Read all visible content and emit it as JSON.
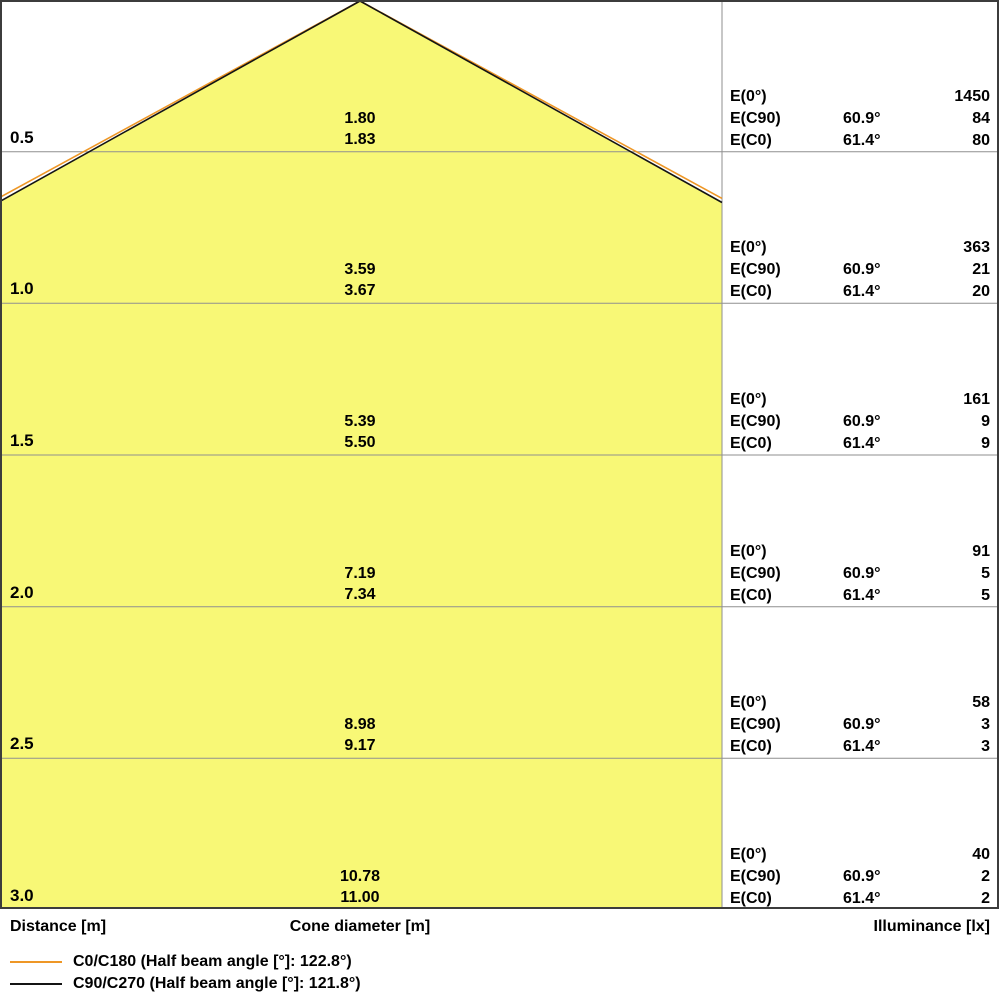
{
  "chart_data": {
    "type": "area",
    "subtype": "photometric-light-cone-diagram",
    "distance_axis_label": "Distance [m]",
    "cone_axis_label": "Cone diameter [m]",
    "illuminance_axis_label": "Illuminance [lx]",
    "half_beam_angle_c0_deg": 61.4,
    "half_beam_angle_c90_deg": 60.9,
    "row_labels": {
      "e0": "E(0°)",
      "ec90": "E(C90)",
      "ec0": "E(C0)"
    },
    "rows": [
      {
        "distance_m": "0.5",
        "cone_diameter_c90_m": "1.80",
        "cone_diameter_c0_m": "1.83",
        "e0_lx": "1450",
        "ec90_angle": "60.9°",
        "ec90_lx": "84",
        "ec0_angle": "61.4°",
        "ec0_lx": "80"
      },
      {
        "distance_m": "1.0",
        "cone_diameter_c90_m": "3.59",
        "cone_diameter_c0_m": "3.67",
        "e0_lx": "363",
        "ec90_angle": "60.9°",
        "ec90_lx": "21",
        "ec0_angle": "61.4°",
        "ec0_lx": "20"
      },
      {
        "distance_m": "1.5",
        "cone_diameter_c90_m": "5.39",
        "cone_diameter_c0_m": "5.50",
        "e0_lx": "161",
        "ec90_angle": "60.9°",
        "ec90_lx": "9",
        "ec0_angle": "61.4°",
        "ec0_lx": "9"
      },
      {
        "distance_m": "2.0",
        "cone_diameter_c90_m": "7.19",
        "cone_diameter_c0_m": "7.34",
        "e0_lx": "91",
        "ec90_angle": "60.9°",
        "ec90_lx": "5",
        "ec0_angle": "61.4°",
        "ec0_lx": "5"
      },
      {
        "distance_m": "2.5",
        "cone_diameter_c90_m": "8.98",
        "cone_diameter_c0_m": "9.17",
        "e0_lx": "58",
        "ec90_angle": "60.9°",
        "ec90_lx": "3",
        "ec0_angle": "61.4°",
        "ec0_lx": "3"
      },
      {
        "distance_m": "3.0",
        "cone_diameter_c90_m": "10.78",
        "cone_diameter_c0_m": "11.00",
        "e0_lx": "40",
        "ec90_angle": "60.9°",
        "ec90_lx": "2",
        "ec0_angle": "61.4°",
        "ec0_lx": "2"
      }
    ],
    "legend": [
      {
        "name": "c0-c180",
        "color": "#ee9726",
        "label": "C0/C180 (Half beam angle [°]: 122.8°)"
      },
      {
        "name": "c90-c270",
        "color": "#141414",
        "label": "C90/C270 (Half beam angle [°]: 121.8°)"
      }
    ],
    "colors": {
      "cone_fill": "#f8f876",
      "c0_line": "#ee9726",
      "c90_line": "#141414",
      "grid_line": "#8f8f8f",
      "border": "#3c3c3c",
      "text": "#000000"
    }
  },
  "footer": {
    "distance": "Distance [m]",
    "cone": "Cone diameter [m]",
    "illuminance": "Illuminance [lx]"
  }
}
